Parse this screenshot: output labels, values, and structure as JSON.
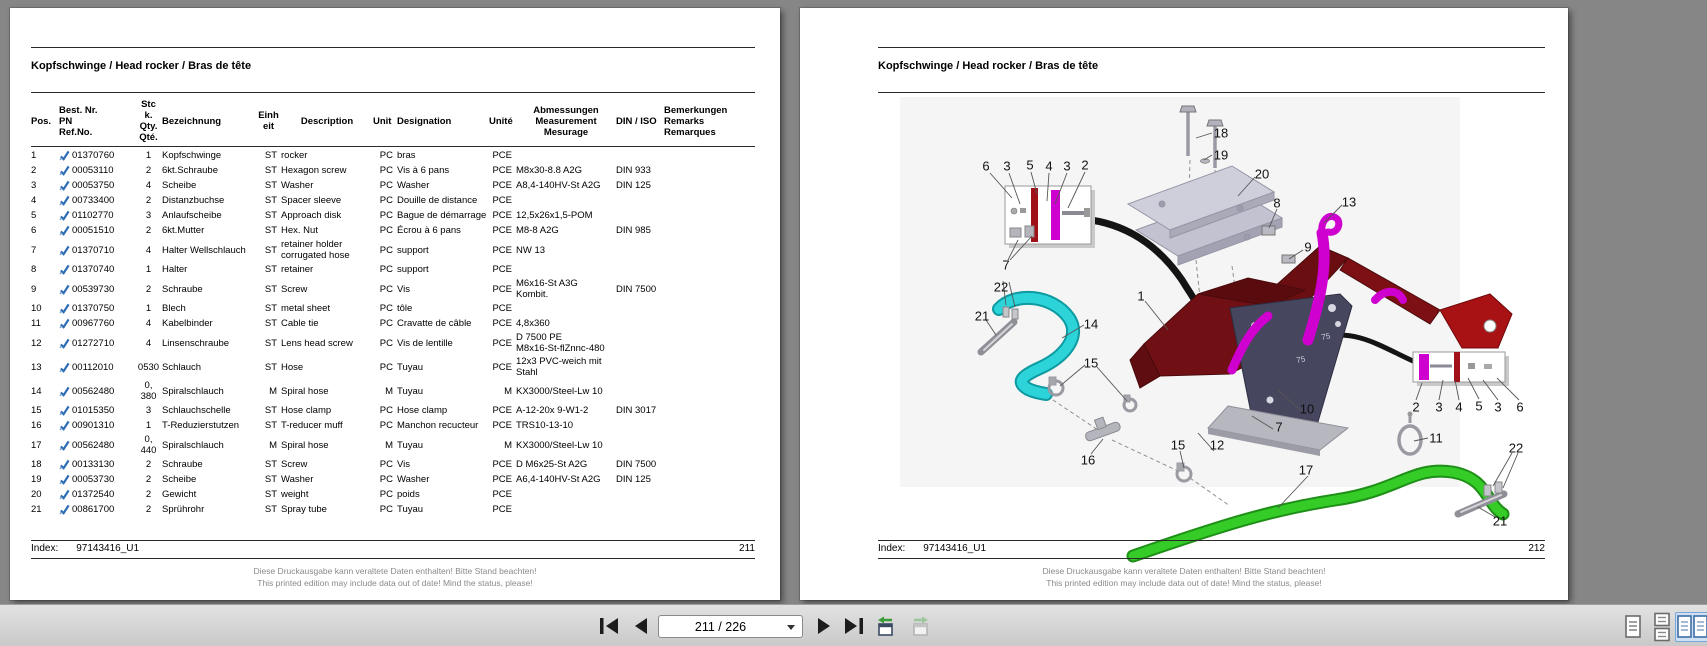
{
  "document": {
    "title": "Kopfschwinge / Head rocker / Bras de tête",
    "index_label": "Index:",
    "index_value": "97143416_U1",
    "disclaimer_de": "Diese Druckausgabe kann veraltete Daten enthalten! Bitte Stand beachten!",
    "disclaimer_en": "This printed edition may include data out of date! Mind the status, please!"
  },
  "left_page": {
    "page_number": "211",
    "table": {
      "headers": {
        "pos": "Pos.",
        "pn": "Best. Nr.\nPN\nRef.No.",
        "qty": "Stc\nk.\nQty.\nQté.",
        "name_de": "Bezeichnung",
        "unit_de": "Einh\neit",
        "name_en": "Description",
        "unit_en": "Unit",
        "name_fr": "Designation",
        "unit_fr": "Unité",
        "dim": "Abmessungen\nMeasurement\nMesurage",
        "din": "DIN / ISO",
        "remarks": "Bemerkungen\nRemarks\nRemarques"
      },
      "rows": [
        {
          "pos": "1",
          "pn": "01370760",
          "qty": "1",
          "name_de": "Kopfschwinge",
          "unit_de": "ST",
          "name_en": "rocker",
          "unit_en": "PC",
          "name_fr": "bras",
          "unit_fr": "PCE",
          "dim": "",
          "din": "",
          "remarks": ""
        },
        {
          "pos": "2",
          "pn": "00053110",
          "qty": "2",
          "name_de": "6kt.Schraube",
          "unit_de": "ST",
          "name_en": "Hexagon screw",
          "unit_en": "PC",
          "name_fr": "Vis à 6 pans",
          "unit_fr": "PCE",
          "dim": "M8x30-8.8 A2G",
          "din": "DIN 933",
          "remarks": ""
        },
        {
          "pos": "3",
          "pn": "00053750",
          "qty": "4",
          "name_de": "Scheibe",
          "unit_de": "ST",
          "name_en": "Washer",
          "unit_en": "PC",
          "name_fr": "Washer",
          "unit_fr": "PCE",
          "dim": "A8,4-140HV-St A2G",
          "din": "DIN 125",
          "remarks": ""
        },
        {
          "pos": "4",
          "pn": "00733400",
          "qty": "2",
          "name_de": "Distanzbuchse",
          "unit_de": "ST",
          "name_en": "Spacer sleeve",
          "unit_en": "PC",
          "name_fr": "Douille de distance",
          "unit_fr": "PCE",
          "dim": "",
          "din": "",
          "remarks": ""
        },
        {
          "pos": "5",
          "pn": "01102770",
          "qty": "3",
          "name_de": "Anlaufscheibe",
          "unit_de": "ST",
          "name_en": "Approach disk",
          "unit_en": "PC",
          "name_fr": "Bague de démarrage",
          "unit_fr": "PCE",
          "dim": "12,5x26x1,5-POM",
          "din": "",
          "remarks": ""
        },
        {
          "pos": "6",
          "pn": "00051510",
          "qty": "2",
          "name_de": "6kt.Mutter",
          "unit_de": "ST",
          "name_en": "Hex. Nut",
          "unit_en": "PC",
          "name_fr": "Écrou à 6 pans",
          "unit_fr": "PCE",
          "dim": "M8-8 A2G",
          "din": "DIN 985",
          "remarks": ""
        },
        {
          "pos": "7",
          "pn": "01370710",
          "qty": "4",
          "name_de": "Halter Wellschlauch",
          "unit_de": "ST",
          "name_en": "retainer holder\ncorrugated hose",
          "unit_en": "PC",
          "name_fr": "support",
          "unit_fr": "PCE",
          "dim": "NW 13",
          "din": "",
          "remarks": ""
        },
        {
          "pos": "8",
          "pn": "01370740",
          "qty": "1",
          "name_de": "Halter",
          "unit_de": "ST",
          "name_en": "retainer",
          "unit_en": "PC",
          "name_fr": "support",
          "unit_fr": "PCE",
          "dim": "",
          "din": "",
          "remarks": ""
        },
        {
          "pos": "9",
          "pn": "00539730",
          "qty": "2",
          "name_de": "Schraube",
          "unit_de": "ST",
          "name_en": "Screw",
          "unit_en": "PC",
          "name_fr": "Vis",
          "unit_fr": "PCE",
          "dim": "M6x16-St A3G\nKombit.",
          "din": "DIN 7500",
          "remarks": ""
        },
        {
          "pos": "10",
          "pn": "01370750",
          "qty": "1",
          "name_de": "Blech",
          "unit_de": "ST",
          "name_en": "metal sheet",
          "unit_en": "PC",
          "name_fr": "tôle",
          "unit_fr": "PCE",
          "dim": "",
          "din": "",
          "remarks": ""
        },
        {
          "pos": "11",
          "pn": "00967760",
          "qty": "4",
          "name_de": "Kabelbinder",
          "unit_de": "ST",
          "name_en": "Cable tie",
          "unit_en": "PC",
          "name_fr": "Cravatte de câble",
          "unit_fr": "PCE",
          "dim": "4,8x360",
          "din": "",
          "remarks": ""
        },
        {
          "pos": "12",
          "pn": "01272710",
          "qty": "4",
          "name_de": "Linsenschraube",
          "unit_de": "ST",
          "name_en": "Lens head screw",
          "unit_en": "PC",
          "name_fr": "Vis de lentille",
          "unit_fr": "PCE",
          "dim": "D 7500 PE\nM8x16-St-flZnnc-480",
          "din": "",
          "remarks": ""
        },
        {
          "pos": "13",
          "pn": "00112010",
          "qty": "0530",
          "name_de": "Schlauch",
          "unit_de": "ST",
          "name_en": "Hose",
          "unit_en": "PC",
          "name_fr": "Tuyau",
          "unit_fr": "PCE",
          "dim": "12x3 PVC-weich mit\nStahl",
          "din": "",
          "remarks": ""
        },
        {
          "pos": "14",
          "pn": "00562480",
          "qty": "0,\n380",
          "name_de": "Spiralschlauch",
          "unit_de": "M",
          "name_en": "Spiral hose",
          "unit_en": "M",
          "name_fr": "Tuyau",
          "unit_fr": "M",
          "dim": "KX3000/Steel-Lw 10",
          "din": "",
          "remarks": ""
        },
        {
          "pos": "15",
          "pn": "01015350",
          "qty": "3",
          "name_de": "Schlauchschelle",
          "unit_de": "ST",
          "name_en": "Hose clamp",
          "unit_en": "PC",
          "name_fr": "Hose clamp",
          "unit_fr": "PCE",
          "dim": "A-12-20x 9-W1-2",
          "din": "DIN 3017",
          "remarks": ""
        },
        {
          "pos": "16",
          "pn": "00901310",
          "qty": "1",
          "name_de": "T-Reduzierstutzen",
          "unit_de": "ST",
          "name_en": "T-reducer muff",
          "unit_en": "PC",
          "name_fr": "Manchon recucteur",
          "unit_fr": "PCE",
          "dim": "TRS10-13-10",
          "din": "",
          "remarks": ""
        },
        {
          "pos": "17",
          "pn": "00562480",
          "qty": "0,\n440",
          "name_de": "Spiralschlauch",
          "unit_de": "M",
          "name_en": "Spiral hose",
          "unit_en": "M",
          "name_fr": "Tuyau",
          "unit_fr": "M",
          "dim": "KX3000/Steel-Lw 10",
          "din": "",
          "remarks": ""
        },
        {
          "pos": "18",
          "pn": "00133130",
          "qty": "2",
          "name_de": "Schraube",
          "unit_de": "ST",
          "name_en": "Screw",
          "unit_en": "PC",
          "name_fr": "Vis",
          "unit_fr": "PCE",
          "dim": "D M6x25-St A2G",
          "din": "DIN 7500",
          "remarks": ""
        },
        {
          "pos": "19",
          "pn": "00053730",
          "qty": "2",
          "name_de": "Scheibe",
          "unit_de": "ST",
          "name_en": "Washer",
          "unit_en": "PC",
          "name_fr": "Washer",
          "unit_fr": "PCE",
          "dim": "A6,4-140HV-St A2G",
          "din": "DIN 125",
          "remarks": ""
        },
        {
          "pos": "20",
          "pn": "01372540",
          "qty": "2",
          "name_de": "Gewicht",
          "unit_de": "ST",
          "name_en": "weight",
          "unit_en": "PC",
          "name_fr": "poids",
          "unit_fr": "PCE",
          "dim": "",
          "din": "",
          "remarks": ""
        },
        {
          "pos": "21",
          "pn": "00861700",
          "qty": "2",
          "name_de": "Sprührohr",
          "unit_de": "ST",
          "name_en": "Spray tube",
          "unit_en": "PC",
          "name_fr": "Tuyau",
          "unit_fr": "PCE",
          "dim": "",
          "din": "",
          "remarks": ""
        }
      ]
    }
  },
  "right_page": {
    "page_number": "212",
    "diagram": {
      "plate_marking": "75",
      "callouts": [
        {
          "n": "6",
          "x": 186,
          "y": 158
        },
        {
          "n": "3",
          "x": 207,
          "y": 158
        },
        {
          "n": "5",
          "x": 230,
          "y": 157
        },
        {
          "n": "4",
          "x": 249,
          "y": 158
        },
        {
          "n": "3",
          "x": 267,
          "y": 158
        },
        {
          "n": "2",
          "x": 285,
          "y": 157
        },
        {
          "n": "18",
          "x": 421,
          "y": 125
        },
        {
          "n": "19",
          "x": 421,
          "y": 147
        },
        {
          "n": "20",
          "x": 462,
          "y": 166
        },
        {
          "n": "8",
          "x": 477,
          "y": 195
        },
        {
          "n": "13",
          "x": 549,
          "y": 194
        },
        {
          "n": "9",
          "x": 508,
          "y": 239
        },
        {
          "n": "7",
          "x": 206,
          "y": 257
        },
        {
          "n": "22",
          "x": 201,
          "y": 279
        },
        {
          "n": "21",
          "x": 182,
          "y": 308
        },
        {
          "n": "1",
          "x": 341,
          "y": 288
        },
        {
          "n": "14",
          "x": 291,
          "y": 316
        },
        {
          "n": "15",
          "x": 291,
          "y": 355
        },
        {
          "n": "16",
          "x": 288,
          "y": 452
        },
        {
          "n": "15",
          "x": 378,
          "y": 437
        },
        {
          "n": "12",
          "x": 417,
          "y": 437
        },
        {
          "n": "7",
          "x": 479,
          "y": 419
        },
        {
          "n": "10",
          "x": 507,
          "y": 401
        },
        {
          "n": "2",
          "x": 616,
          "y": 399
        },
        {
          "n": "3",
          "x": 639,
          "y": 399
        },
        {
          "n": "4",
          "x": 659,
          "y": 399
        },
        {
          "n": "5",
          "x": 679,
          "y": 398
        },
        {
          "n": "3",
          "x": 698,
          "y": 399
        },
        {
          "n": "6",
          "x": 720,
          "y": 399
        },
        {
          "n": "11",
          "x": 636,
          "y": 430
        },
        {
          "n": "17",
          "x": 506,
          "y": 462
        },
        {
          "n": "22",
          "x": 716,
          "y": 440
        },
        {
          "n": "21",
          "x": 700,
          "y": 513
        }
      ]
    }
  },
  "toolbar": {
    "page_indicator": "211 / 226"
  }
}
